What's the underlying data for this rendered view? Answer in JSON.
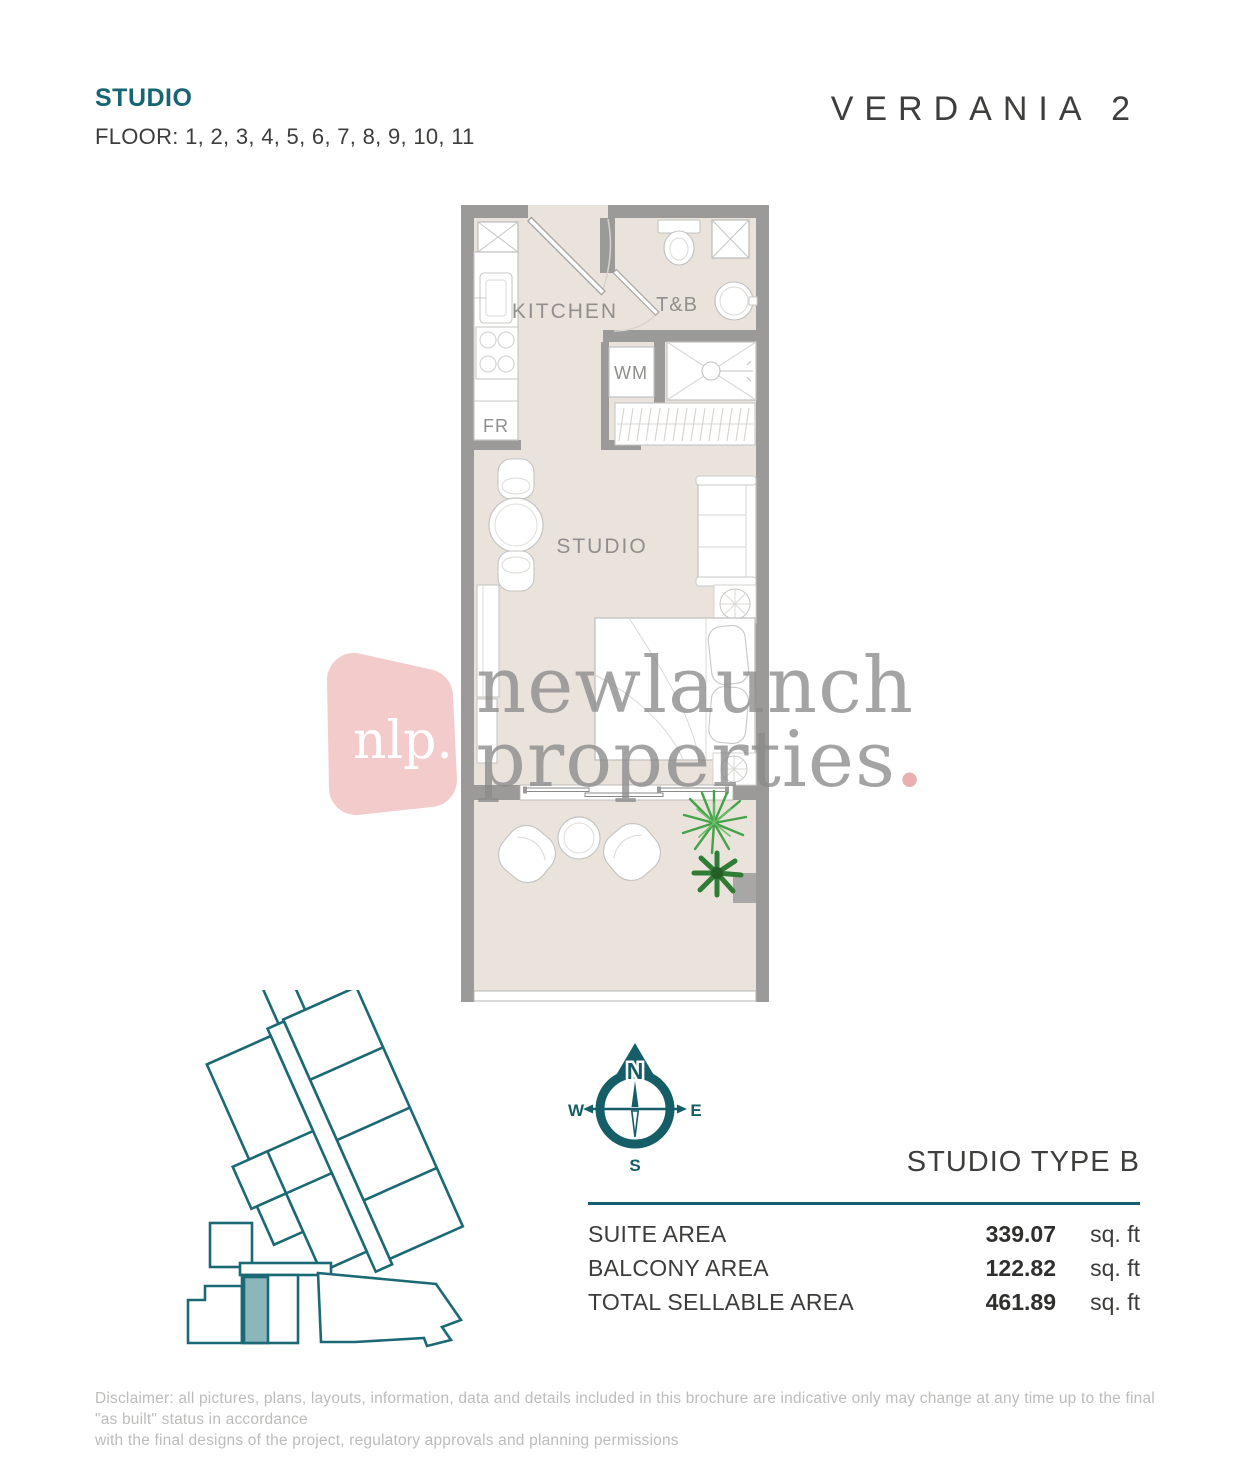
{
  "header": {
    "unit_type": "STUDIO",
    "floors": "FLOOR: 1, 2, 3, 4, 5, 6, 7, 8, 9, 10, 11",
    "brand": "VERDANIA 2"
  },
  "floor_plan": {
    "kitchen_label": "KITCHEN",
    "tnb_label": "T&B",
    "wm_label": "WM",
    "fr_label": "FR",
    "studio_label": "STUDIO"
  },
  "watermark": {
    "logo_text": "nlp.",
    "line1": "newlaunch",
    "line2": "properties",
    "dot": "."
  },
  "compass": {
    "north": "N",
    "south": "S",
    "east": "E",
    "west": "W"
  },
  "unit_info": {
    "title": "STUDIO TYPE B",
    "rows": [
      {
        "label": "SUITE AREA",
        "value": "339.07",
        "unit": "sq. ft"
      },
      {
        "label": "BALCONY AREA",
        "value": "122.82",
        "unit": "sq. ft"
      },
      {
        "label": "TOTAL SELLABLE AREA",
        "value": "461.89",
        "unit": "sq. ft"
      }
    ]
  },
  "disclaimer": {
    "line1": "Disclaimer: all pictures, plans, layouts, information, data and details included in this brochure are indicative only may change at any time up to the final \"as built\" status in accordance",
    "line2": "with the final designs of the project, regulatory approvals and planning permissions"
  },
  "colors": {
    "accent_teal": "#15626e",
    "wall_gray": "#9b9a98",
    "floor_beige": "#eae3dc",
    "logo_pink": "#f2c7c6",
    "highlight_unit": "#8cb7ba"
  }
}
